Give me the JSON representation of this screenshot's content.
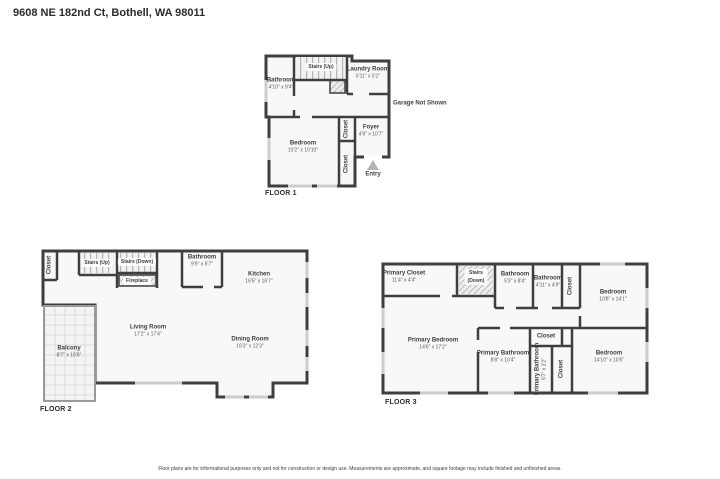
{
  "header": {
    "title": "9608 NE 182nd Ct, Bothell, WA 98011"
  },
  "footer": {
    "disclaimer": "Floor plans are for informational purposes only and not for construction or design use. Measurements are approximate, and square footage may include finished and unfinished areas."
  },
  "style": {
    "wall_color": "#3f3f3f",
    "room_fill": "#f8f8f7",
    "window_color": "#cdcdcd"
  },
  "floor1": {
    "label": "FLOOR 1",
    "rooms": {
      "bathroom": {
        "name": "Bathroom",
        "dims": "4'10\" x 9'4\""
      },
      "stairs_up": {
        "name": "Stairs (Up)"
      },
      "laundry": {
        "name": "Laundry Room",
        "dims": "5'11\" x 5'1\""
      },
      "garage_note": {
        "name": "Garage Not Shown"
      },
      "foyer": {
        "name": "Foyer",
        "dims": "4'9\" x 10'7\""
      },
      "closet_upper": {
        "name": "Closet"
      },
      "closet_lower": {
        "name": "Closet"
      },
      "bedroom": {
        "name": "Bedroom",
        "dims": "10'2\" x 10'10\""
      },
      "entry": {
        "name": "Entry"
      }
    }
  },
  "floor2": {
    "label": "FLOOR 2",
    "rooms": {
      "closet": {
        "name": "Closet"
      },
      "stairs_up": {
        "name": "Stairs (Up)"
      },
      "stairs_down": {
        "name": "Stairs (Down)"
      },
      "fireplace": {
        "name": "Fireplace"
      },
      "bathroom": {
        "name": "Bathroom",
        "dims": "9'9\" x 5'7\""
      },
      "kitchen": {
        "name": "Kitchen",
        "dims": "16'5\" x 16'7\""
      },
      "living_room": {
        "name": "Living Room",
        "dims": "17'2\" x 17'4\""
      },
      "dining_room": {
        "name": "Dining Room",
        "dims": "16'3\" x 12'3\""
      },
      "balcony": {
        "name": "Balcony",
        "dims": "8'7\" x 15'6\""
      }
    }
  },
  "floor3": {
    "label": "FLOOR 3",
    "rooms": {
      "primary_closet": {
        "name": "Primary Closet",
        "dims": "11'4\" x 4'4\""
      },
      "stairs_down": {
        "name": "Stairs",
        "name2": "(Down)"
      },
      "bathroom_left": {
        "name": "Bathroom",
        "dims": "5'3\" x 8'4\""
      },
      "bathroom_right": {
        "name": "Bathroom",
        "dims": "4'11\" x 4'9\""
      },
      "closet_top": {
        "name": "Closet"
      },
      "bedroom_top": {
        "name": "Bedroom",
        "dims": "10'8\" x 14'1\""
      },
      "primary_bedroom": {
        "name": "Primary Bedroom",
        "dims": "14'6\" x 17'2\""
      },
      "closet_mid": {
        "name": "Closet"
      },
      "primary_bathroom": {
        "name": "Primary Bathroom",
        "dims": "8'8\" x 10'4\""
      },
      "primary_bathroom_small": {
        "name": "Primary Bathroom",
        "dims": "5'7\" x 3'2\""
      },
      "closet_bottom": {
        "name": "Closet"
      },
      "bedroom_bottom": {
        "name": "Bedroom",
        "dims": "14'10\" x 10'5\""
      }
    }
  }
}
